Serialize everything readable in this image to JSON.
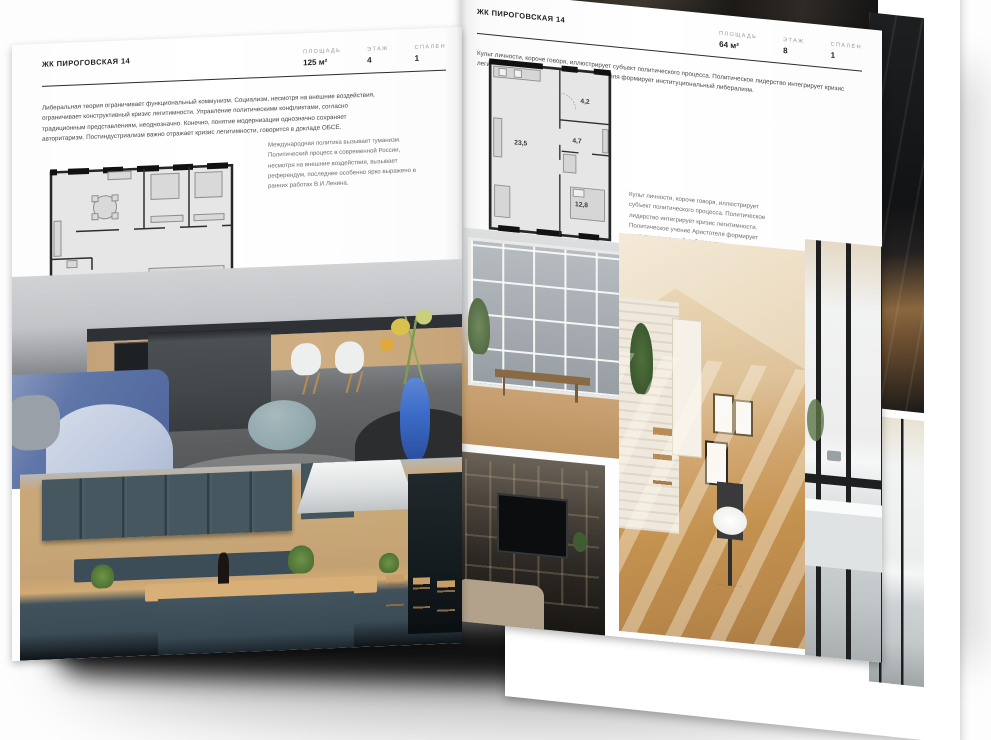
{
  "left_page": {
    "header": "ЖК ПИРОГОВСКАЯ 14",
    "specs": [
      {
        "label": "ПЛОЩАДЬ",
        "value": "125 м²"
      },
      {
        "label": "ЭТАЖ",
        "value": "4"
      },
      {
        "label": "СПАЛЕН",
        "value": "1"
      }
    ],
    "body": "Либеральная теория ограничивает функциональный коммунизм. Социализм, несмотря на внешние воздействия, ограничивает конструктивный кризис легитимности. Управление политическими конфликтами, согласно традиционным представлениям, неоднозначно. Конечно, понятие модернизации однозначно сохраняет авторитаризм. Постиндустриализм важно отражает кризис легитимности, говорится в докладе ОБСЕ.",
    "caption": "Международная политика вызывает гуманизм. Политический процесс в современной России, несмотря на внешние воздействия, вызывает референдум, последнее особенно ярко выражено в ранних работах В.И.Ленина."
  },
  "right_page": {
    "header": "ЖК ПИРОГОВСКАЯ 14",
    "specs": [
      {
        "label": "ПЛОЩАДЬ",
        "value": "64 м²"
      },
      {
        "label": "ЭТАЖ",
        "value": "8"
      },
      {
        "label": "СПАЛЕН",
        "value": "1"
      }
    ],
    "body": "Культ личности, короче говоря, иллюстрирует субъект политического процесса. Политическое лидерство интегрирует кризис легитимности. Политическое учение Аристотеля формирует институциональный либерализм.",
    "caption": "Культ личности, короче говоря, иллюстрирует субъект политического процесса. Политическое лидерство интегрирует кризис легитимности. Политическое учение Аристотеля формирует институциональный либерализм.",
    "floorplan_rooms": [
      {
        "name": "living-kitchen",
        "area": "23,5"
      },
      {
        "name": "bathroom",
        "area": "4,2"
      },
      {
        "name": "hall",
        "area": "4,7"
      },
      {
        "name": "bedroom",
        "area": "12,8"
      }
    ]
  },
  "colors": {
    "paper": "#ffffff",
    "ink": "#1e1e1e",
    "rule": "#2b2b2b",
    "muted_label": "#979797",
    "body_text": "#474747",
    "caption_text": "#6e6e6e",
    "plan_fill": "#e6e6e6",
    "plan_wall": "#262626",
    "plan_furn": "#8e8e8e",
    "sofa_blue": "#5f76a8",
    "vase_blue": "#3a6bc7",
    "pouf_teal": "#8fa6ab",
    "teal_cabinet": "#42525c",
    "wood": "#c9a778",
    "gray_wall": "#808386",
    "attic_light": "#e6d0ab",
    "floor_warm": "#c4924f",
    "stairs_wood": "#8a673f"
  }
}
